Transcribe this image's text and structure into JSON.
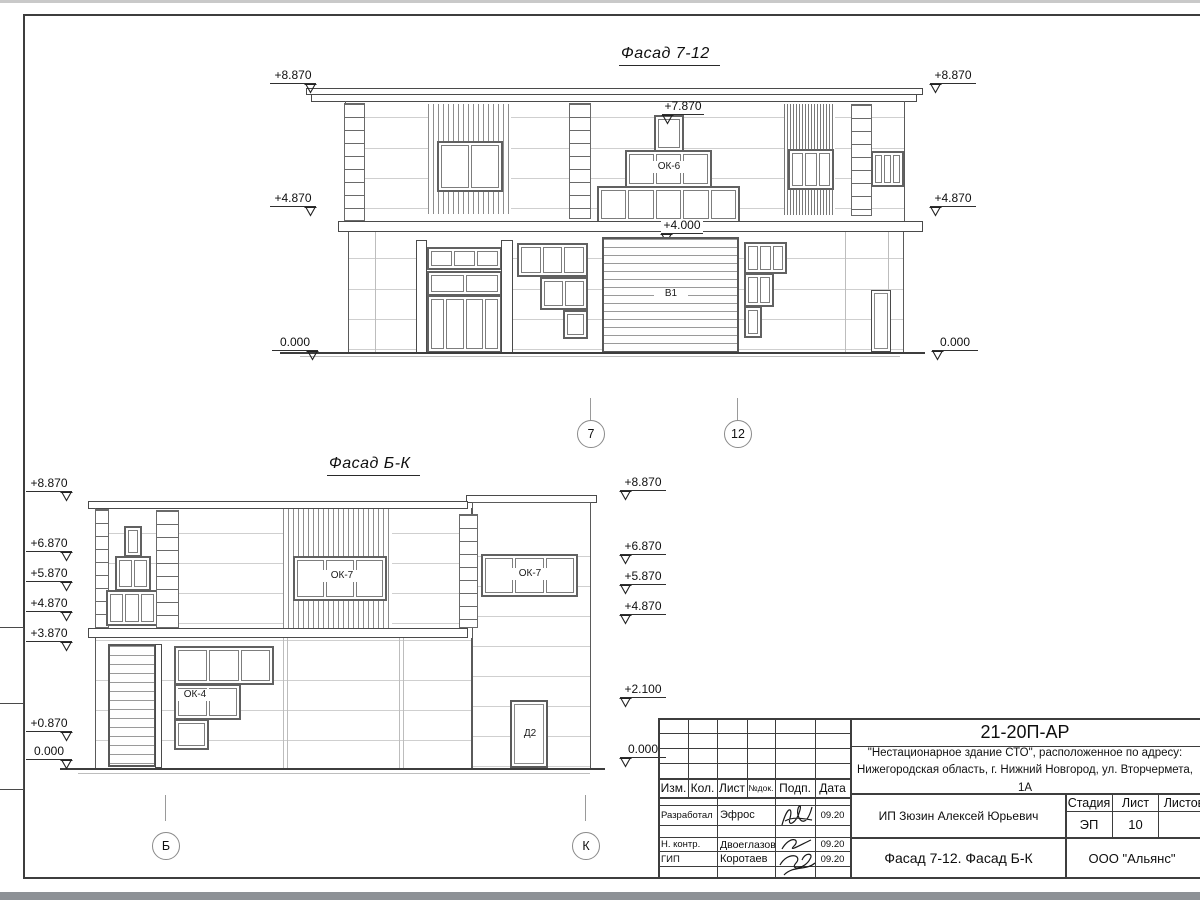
{
  "facade_top": {
    "title": "Фасад 7-12",
    "marks_left": [
      "+8.870",
      "+4.870",
      "0.000"
    ],
    "marks_right": [
      "+8.870",
      "+4.870",
      "0.000"
    ],
    "mark_peak": "+7.870",
    "mark_gate": "+4.000",
    "window_label": "ОК-6",
    "gate_label": "В1",
    "axes": [
      "7",
      "12"
    ]
  },
  "facade_side": {
    "title": "Фасад Б-К",
    "marks_left": [
      "+8.870",
      "+6.870",
      "+5.870",
      "+4.870",
      "+3.870",
      "+0.870",
      "0.000"
    ],
    "marks_right": [
      "+8.870",
      "+6.870",
      "+5.870",
      "+4.870",
      "+2.100",
      "0.000"
    ],
    "window_labels": {
      "upper_left": "ОК-7",
      "upper_right": "ОК-7",
      "lower": "ОК-4"
    },
    "door_label": "Д2",
    "axes": [
      "Б",
      "К"
    ]
  },
  "title_block": {
    "code": "21-20П-АР",
    "address_line1": "\"Нестационарное здание СТО\", расположенное по адресу:",
    "address_line2": "Нижегородская область, г. Нижний Новгород, ул. Вторчермета, 1А",
    "columns": [
      "Изм.",
      "Кол.",
      "Лист",
      "№док.",
      "Подп.",
      "Дата"
    ],
    "rows": [
      {
        "role": "Разработал",
        "name": "Эфрос",
        "date": "09.20"
      },
      {
        "role": "Н. контр.",
        "name": "Двоеглазов",
        "date": "09.20"
      },
      {
        "role": "ГИП",
        "name": "Коротаев",
        "date": "09.20"
      }
    ],
    "client": "ИП Зюзин Алексей Юрьевич",
    "stage_header": [
      "Стадия",
      "Лист",
      "Листов"
    ],
    "stage": "ЭП",
    "sheet_number": "10",
    "sheet_title": "Фасад 7-12. Фасад Б-К",
    "organization": "ООО \"Альянс\""
  }
}
